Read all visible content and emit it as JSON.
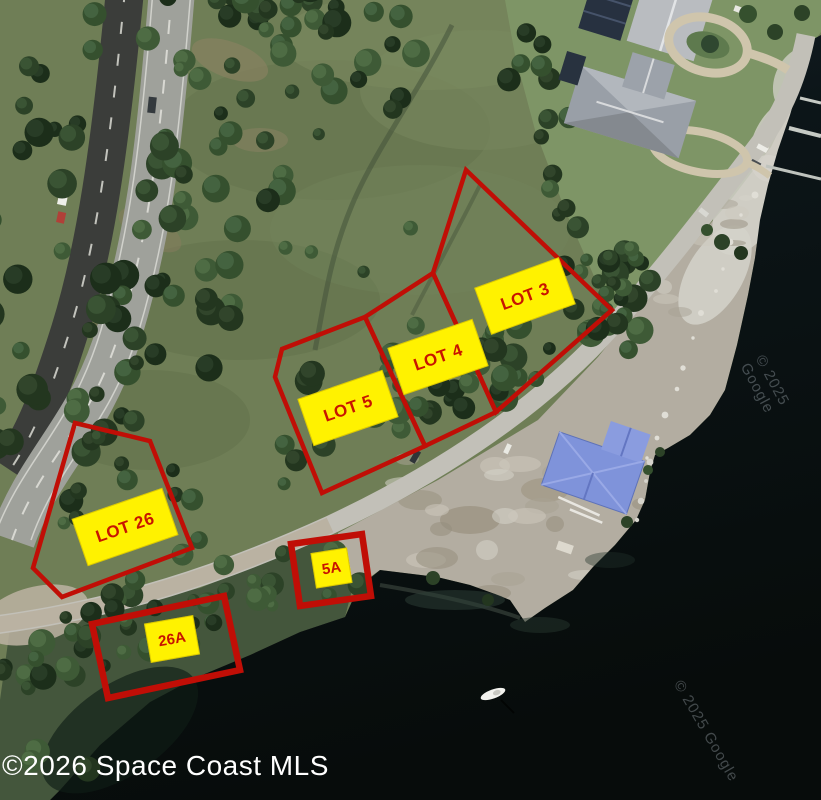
{
  "canvas": {
    "width": 821,
    "height": 800
  },
  "map": {
    "type": "satellite-aerial-lot-map",
    "lot_labels": [
      {
        "id": "lot-26",
        "label": "LOT 26"
      },
      {
        "id": "lot-5",
        "label": "LOT 5"
      },
      {
        "id": "lot-4",
        "label": "LOT 4"
      },
      {
        "id": "lot-3",
        "label": "LOT 3"
      },
      {
        "id": "lot-5a",
        "label": "5A"
      },
      {
        "id": "lot-26a",
        "label": "26A"
      }
    ]
  },
  "watermarks": {
    "mls": "©2026 Space Coast MLS",
    "imagery_right": "© 2025 Google",
    "imagery_bottom": "© 2025 Google"
  },
  "colors": {
    "lot_boundary": "#C00E06",
    "label_background": "#FFF200",
    "label_text": "#C81400",
    "mls_watermark": "#FFFFFF",
    "google_watermark": "rgba(205,215,225,0.30)"
  }
}
